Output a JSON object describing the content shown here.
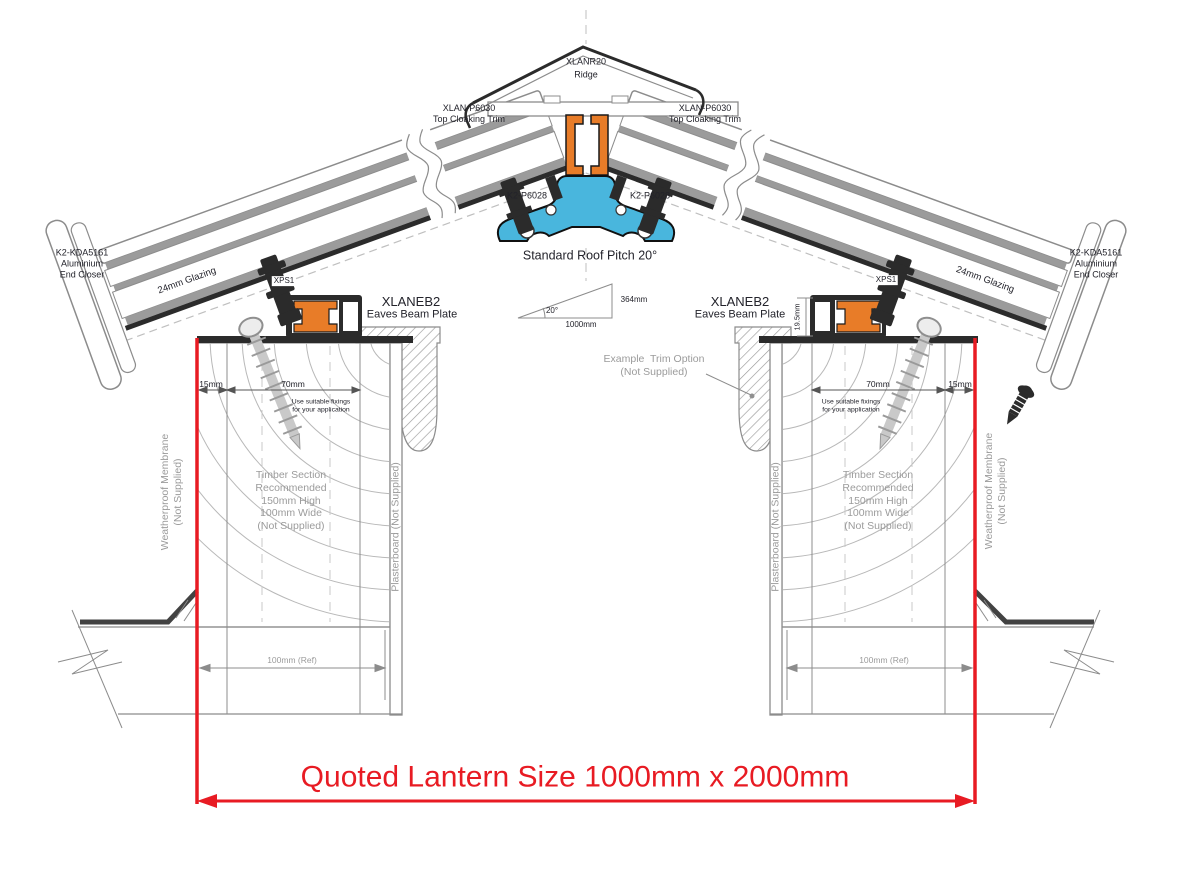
{
  "colors": {
    "accent_red": "#e81b23",
    "profile_orange": "#e87c28",
    "profile_blue": "#49b6dd",
    "line_dark": "#2b2b2b",
    "line_gray": "#8c8c8c",
    "fill_gray": "#9b9b9b",
    "text_dark": "#23232b",
    "text_gray": "#9b9b9b"
  },
  "ridge": {
    "model": "XLANR20",
    "name": "Ridge"
  },
  "cloaking_trim": {
    "model": "XLAN-P6030",
    "name": "Top Cloaking Trim"
  },
  "ridge_fixing": "K2-P6028",
  "pitch": {
    "label": "Standard Roof Pitch 20°",
    "angle": "20°",
    "run": "1000mm",
    "rise": "364mm"
  },
  "glazing_label": "24mm Glazing",
  "end_closer": {
    "model": "K2-KDA5161",
    "material": "Aluminium",
    "name": "End Closer"
  },
  "gasket": "XPS1",
  "eaves_beam": {
    "model": "XLANEB2",
    "name": "Eaves Beam Plate",
    "height": "19.5mm"
  },
  "trim_option": [
    "Example  Trim Option",
    "(Not Supplied)"
  ],
  "dimensions": {
    "edge": "15mm",
    "fixing_zone": "70mm",
    "upstand_ref": "100mm (Ref)"
  },
  "fixing_note": [
    "Use suitable fixings",
    "for your application"
  ],
  "timber_note": [
    "Timber Section",
    "Recommended",
    "150mm High",
    "100mm Wide",
    "(Not Supplied)"
  ],
  "membrane_note": [
    "Weatherproof Membrane",
    "(Not Supplied)"
  ],
  "plasterboard_note": "Plasterboard (Not Supplied)",
  "quoted_size": "Quoted Lantern Size 1000mm x 2000mm"
}
